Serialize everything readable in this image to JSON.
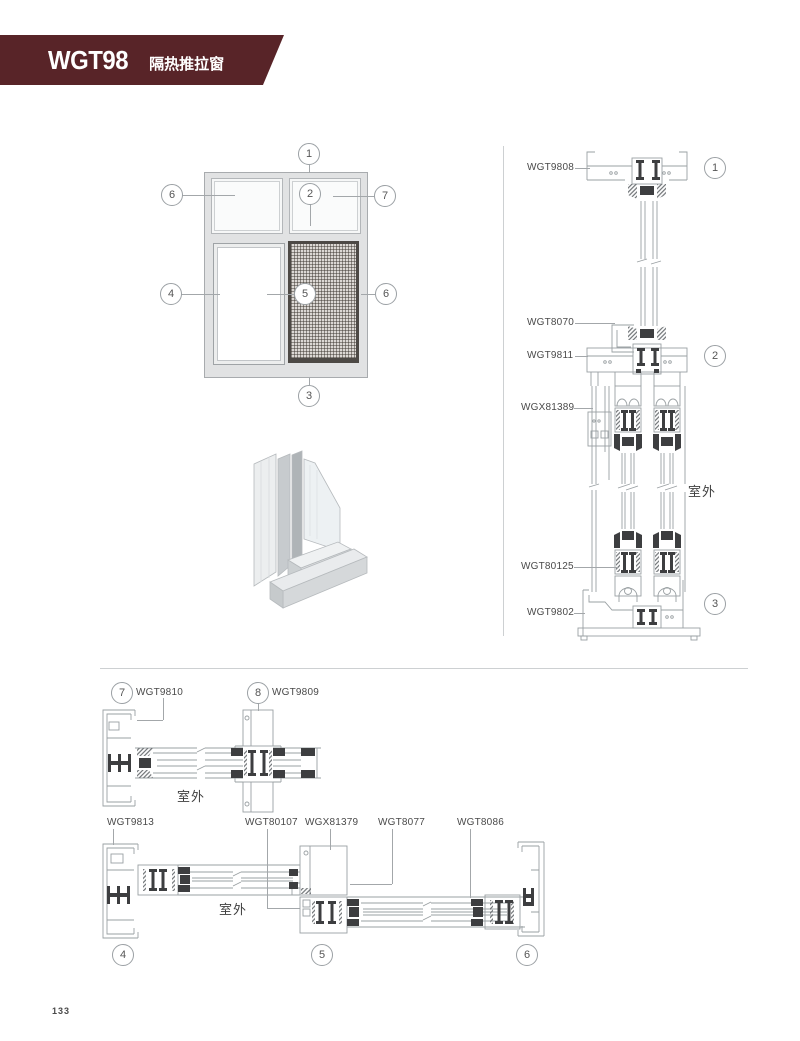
{
  "header": {
    "code": "WGT98",
    "subtitle": "隔热推拉窗"
  },
  "page_number": "133",
  "elevation": {
    "callouts": {
      "c1": "1",
      "c2": "2",
      "c3": "3",
      "c4": "4",
      "c5": "5",
      "c6_left": "6",
      "c6_right": "6",
      "c7": "7"
    }
  },
  "vertical_section": {
    "parts": {
      "p1": "WGT9808",
      "p2": "WGT8070",
      "p3": "WGT9811",
      "p4": "WGX81389",
      "p5": "WGT80125",
      "p6": "WGT9802"
    },
    "callouts": {
      "c1": "1",
      "c2": "2",
      "c3": "3"
    },
    "outdoor": "室外"
  },
  "plan_top": {
    "parts": {
      "p7": "WGT9810",
      "p8": "WGT9809"
    },
    "callouts": {
      "c7": "7",
      "c8": "8"
    },
    "outdoor": "室外"
  },
  "plan_bottom": {
    "parts": {
      "p1": "WGT9813",
      "p2": "WGT80107",
      "p3": "WGX81379",
      "p4": "WGT8077",
      "p5": "WGT8086"
    },
    "callouts": {
      "c4": "4",
      "c5": "5",
      "c6": "6"
    },
    "outdoor": "室外"
  }
}
